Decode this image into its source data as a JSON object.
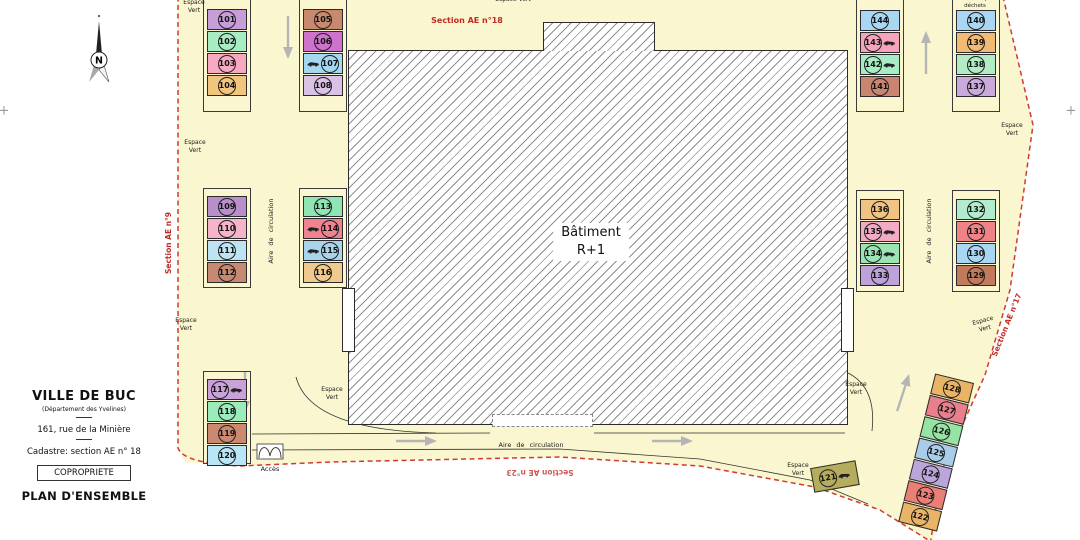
{
  "colors": {
    "site_fill": "#FAF6CF",
    "boundary_red": "#CE3B34",
    "hatch_gray": "#8F8F8F",
    "frame_black": "#3A3A3A"
  },
  "building": {
    "line1": "Bâtiment",
    "line2": "R+1"
  },
  "north_label": "N",
  "title_block": {
    "city": "VILLE DE BUC",
    "department": "(Département des Yvelines)",
    "address": "161, rue de la Minière",
    "cadastre": "Cadastre: section AE n° 18",
    "tenure": "COPROPRIETE",
    "plan_title": "PLAN D'ENSEMBLE"
  },
  "frames": [
    {
      "x": 203,
      "y": -4,
      "w": 48,
      "h": 116
    },
    {
      "x": 299,
      "y": -4,
      "w": 48,
      "h": 116
    },
    {
      "x": 203,
      "y": 188,
      "w": 48,
      "h": 100
    },
    {
      "x": 299,
      "y": 188,
      "w": 48,
      "h": 100
    },
    {
      "x": 203,
      "y": 371,
      "w": 48,
      "h": 93
    },
    {
      "x": 856,
      "y": -4,
      "w": 48,
      "h": 116
    },
    {
      "x": 952,
      "y": -4,
      "w": 48,
      "h": 116
    },
    {
      "x": 856,
      "y": 190,
      "w": 48,
      "h": 102
    },
    {
      "x": 952,
      "y": 190,
      "w": 48,
      "h": 102
    }
  ],
  "stall_groups": [
    {
      "x": 207,
      "y": 9,
      "w": 40,
      "items": [
        {
          "n": "101",
          "c": "#C79ED8"
        },
        {
          "n": "102",
          "c": "#A8ECC2"
        },
        {
          "n": "103",
          "c": "#F6A9C1"
        },
        {
          "n": "104",
          "c": "#F2C57F"
        }
      ]
    },
    {
      "x": 303,
      "y": 9,
      "w": 40,
      "items": [
        {
          "n": "105",
          "c": "#C8896E"
        },
        {
          "n": "106",
          "c": "#CE72CE"
        },
        {
          "n": "107",
          "c": "#A5D8F0",
          "car": "left"
        },
        {
          "n": "108",
          "c": "#D9C2E6"
        }
      ]
    },
    {
      "x": 207,
      "y": 196,
      "w": 40,
      "items": [
        {
          "n": "109",
          "c": "#B88FCB"
        },
        {
          "n": "110",
          "c": "#F5B4C9"
        },
        {
          "n": "111",
          "c": "#BEE3F2"
        },
        {
          "n": "112",
          "c": "#C68971"
        }
      ]
    },
    {
      "x": 303,
      "y": 196,
      "w": 40,
      "items": [
        {
          "n": "113",
          "c": "#8FE6B3"
        },
        {
          "n": "114",
          "c": "#EF8390",
          "car": "left"
        },
        {
          "n": "115",
          "c": "#A9D4EA",
          "car": "left"
        },
        {
          "n": "116",
          "c": "#F0C98D"
        }
      ]
    },
    {
      "x": 207,
      "y": 379,
      "w": 40,
      "items": [
        {
          "n": "117",
          "c": "#C9A2DA",
          "car": "right"
        },
        {
          "n": "118",
          "c": "#9BECBB"
        },
        {
          "n": "119",
          "c": "#CB8970"
        },
        {
          "n": "120",
          "c": "#B9E6F6"
        }
      ]
    },
    {
      "x": 860,
      "y": 10,
      "w": 40,
      "items": [
        {
          "n": "144",
          "c": "#A9D6F2"
        },
        {
          "n": "143",
          "c": "#F6A4BB",
          "car": "right"
        },
        {
          "n": "142",
          "c": "#A8ECC5",
          "car": "right"
        },
        {
          "n": "141",
          "c": "#C9856F"
        }
      ]
    },
    {
      "x": 956,
      "y": 10,
      "w": 40,
      "items": [
        {
          "n": "140",
          "c": "#A9D6F2"
        },
        {
          "n": "139",
          "c": "#F2BA72"
        },
        {
          "n": "138",
          "c": "#B1ECC5"
        },
        {
          "n": "137",
          "c": "#C9AADB"
        }
      ]
    },
    {
      "x": 860,
      "y": 199,
      "w": 40,
      "items": [
        {
          "n": "136",
          "c": "#F0C383"
        },
        {
          "n": "135",
          "c": "#F2AAC5",
          "car": "right"
        },
        {
          "n": "134",
          "c": "#9BE4B4",
          "car": "right"
        },
        {
          "n": "133",
          "c": "#BEA2DA"
        }
      ]
    },
    {
      "x": 956,
      "y": 199,
      "w": 40,
      "items": [
        {
          "n": "132",
          "c": "#B1ECCF"
        },
        {
          "n": "131",
          "c": "#EF8388"
        },
        {
          "n": "130",
          "c": "#A9D6F2"
        },
        {
          "n": "129",
          "c": "#C2795C"
        }
      ]
    },
    {
      "x": 916,
      "y": 376,
      "w": 40,
      "rot": 14,
      "items": [
        {
          "n": "128",
          "c": "#EAB466"
        },
        {
          "n": "127",
          "c": "#E97F8C"
        },
        {
          "n": "126",
          "c": "#96E3A4"
        },
        {
          "n": "125",
          "c": "#A9CDE9"
        },
        {
          "n": "124",
          "c": "#BCA5DB"
        },
        {
          "n": "123",
          "c": "#E97F75"
        },
        {
          "n": "122",
          "c": "#EAB466"
        }
      ]
    },
    {
      "x": 812,
      "y": 464,
      "w": 46,
      "pitch": 26,
      "rot": -10,
      "items": [
        {
          "n": "121",
          "c": "#B5AC5E",
          "car": "right"
        }
      ]
    }
  ],
  "labels": [
    {
      "name": "espace-vert-label",
      "lines": [
        "Espace",
        "Vert"
      ],
      "x": 194,
      "y": 7
    },
    {
      "name": "espace-vert-label",
      "lines": [
        "Espace Vert"
      ],
      "x": 513,
      "y": 0
    },
    {
      "name": "espace-vert-label",
      "lines": [
        "Espace",
        "Vert"
      ],
      "x": 195,
      "y": 147
    },
    {
      "name": "espace-vert-label",
      "lines": [
        "Espace",
        "Vert"
      ],
      "x": 186,
      "y": 325
    },
    {
      "name": "espace-vert-label",
      "lines": [
        "Espace",
        "Vert"
      ],
      "x": 332,
      "y": 394
    },
    {
      "name": "espace-vert-label",
      "lines": [
        "Espace",
        "Vert"
      ],
      "x": 856,
      "y": 389
    },
    {
      "name": "espace-vert-label",
      "lines": [
        "Espace",
        "Vert"
      ],
      "x": 1012,
      "y": 130
    },
    {
      "name": "espace-vert-label",
      "lines": [
        "Espace",
        "Vert"
      ],
      "x": 984,
      "y": 325,
      "rot": -15
    },
    {
      "name": "espace-vert-label",
      "lines": [
        "Espace",
        "Vert"
      ],
      "x": 798,
      "y": 470
    },
    {
      "name": "aire-de-circulation-label",
      "lines": [
        "Aire de circulation"
      ],
      "x": 271,
      "y": 231,
      "rot": -90,
      "size": 6.5,
      "ws": true
    },
    {
      "name": "aire-de-circulation-label",
      "lines": [
        "Aire de circulation"
      ],
      "x": 929,
      "y": 231,
      "rot": -90,
      "size": 6.5,
      "ws": true
    },
    {
      "name": "aire-de-circulation-label",
      "lines": [
        "Aire de circulation"
      ],
      "x": 531,
      "y": 445,
      "size": 6.5,
      "ws": true
    },
    {
      "name": "aire-depot-dechets-label",
      "lines": [
        "Aire de dépôt",
        "déchets"
      ],
      "x": 975,
      "y": 3,
      "size": 5.5
    },
    {
      "name": "acces-label",
      "lines": [
        "Accès"
      ],
      "x": 270,
      "y": 469,
      "size": 6.5
    },
    {
      "name": "section-ae-18-label",
      "lines": [
        "Section AE n°18"
      ],
      "x": 467,
      "y": 21,
      "size": 8,
      "color": "#C22B24",
      "bold": true
    },
    {
      "name": "section-ae-9-label",
      "lines": [
        "Section AE n°9"
      ],
      "x": 169,
      "y": 243,
      "rot": -90,
      "size": 7.5,
      "color": "#C22B24",
      "bold": true
    },
    {
      "name": "section-ae-17-label",
      "lines": [
        "Section AE n°17"
      ],
      "x": 1007,
      "y": 325,
      "rot": -68,
      "size": 7.5,
      "color": "#C22B24",
      "bold": true
    },
    {
      "name": "section-ae-23-label",
      "lines": [
        "Section AE n°23"
      ],
      "x": 540,
      "y": 472,
      "rot": 180,
      "size": 7.5,
      "color": "#C22B24",
      "bold": true,
      "dim": true
    },
    {
      "name": "register-cross",
      "lines": [
        "+"
      ],
      "x": 4,
      "y": 112,
      "size": 13,
      "color": "#999"
    },
    {
      "name": "register-cross",
      "lines": [
        "+"
      ],
      "x": 1071,
      "y": 112,
      "size": 13,
      "color": "#999"
    }
  ]
}
